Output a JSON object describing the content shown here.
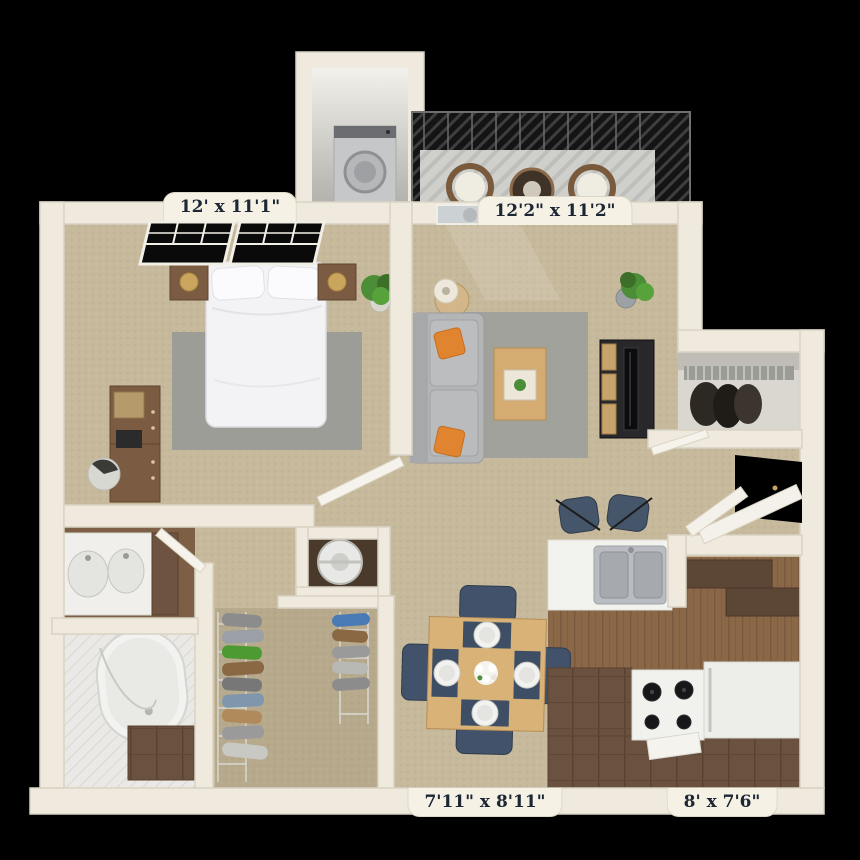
{
  "floorplan": {
    "type": "3D top-down apartment floor plan render",
    "labels": {
      "bedroom": "12' x 11'1\"",
      "living_room": "12'2\" x 11'2\"",
      "dining": "7'11\" x 8'11\"",
      "kitchen": "8' x 7'6\""
    },
    "palette": {
      "background": "#000000",
      "wall": "#efeadd",
      "wall_edge": "#d9d3c3",
      "carpet": "#c6b99c",
      "closet_carpet": "#b7a98c",
      "rug": "#a2a29c",
      "kitchen_wood": "#8a6747",
      "counter_brown": "#6b5140",
      "upper_cabinet": "#5c4636",
      "bath_tile": "#eae9e5",
      "sofa_gray": "#b4b5b7",
      "pillow_orange": "#e08430",
      "navy": "#42526a",
      "table_wood": "#d8b277",
      "plant_green": "#4c8d38",
      "deck_gray": "#cfcfcb",
      "railing_dark": "#141414",
      "label_bg": "#f5f1e5",
      "label_text": "#1d2635"
    }
  }
}
